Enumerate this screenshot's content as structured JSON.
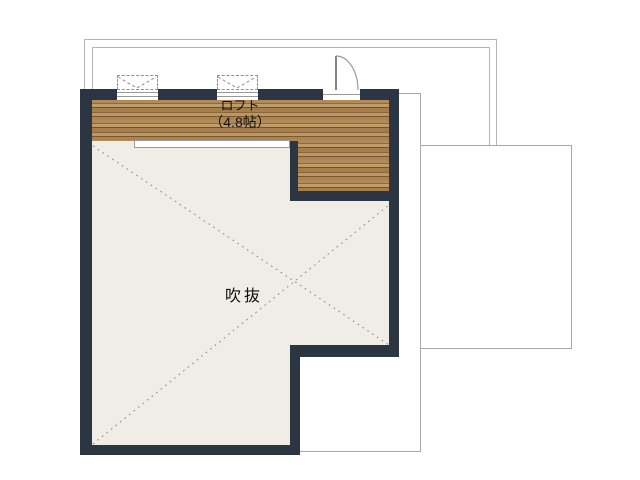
{
  "plan": {
    "type": "floor-plan",
    "floor": "loft level",
    "rooms": [
      {
        "id": "loft",
        "label": "ロフト",
        "size": "（4.8帖）",
        "floor_finish": "wood"
      },
      {
        "id": "void",
        "label": "吹抜",
        "floor_finish": "plaster"
      }
    ],
    "symbols": [
      {
        "name": "window-symbol",
        "count": 2
      },
      {
        "name": "door-symbol",
        "count": 1
      },
      {
        "name": "void-cross-lines",
        "count": 1
      }
    ]
  },
  "colors": {
    "wall": "#2c3542",
    "void_floor": "#f0ede6",
    "wood_light": "#c09c6a",
    "wood_dark": "#6f5229",
    "roof_outline": "#b5b5b5",
    "lower_floor_outline": "#a8a8a8",
    "dotted_line": "#9a9389",
    "text": "#111111"
  }
}
